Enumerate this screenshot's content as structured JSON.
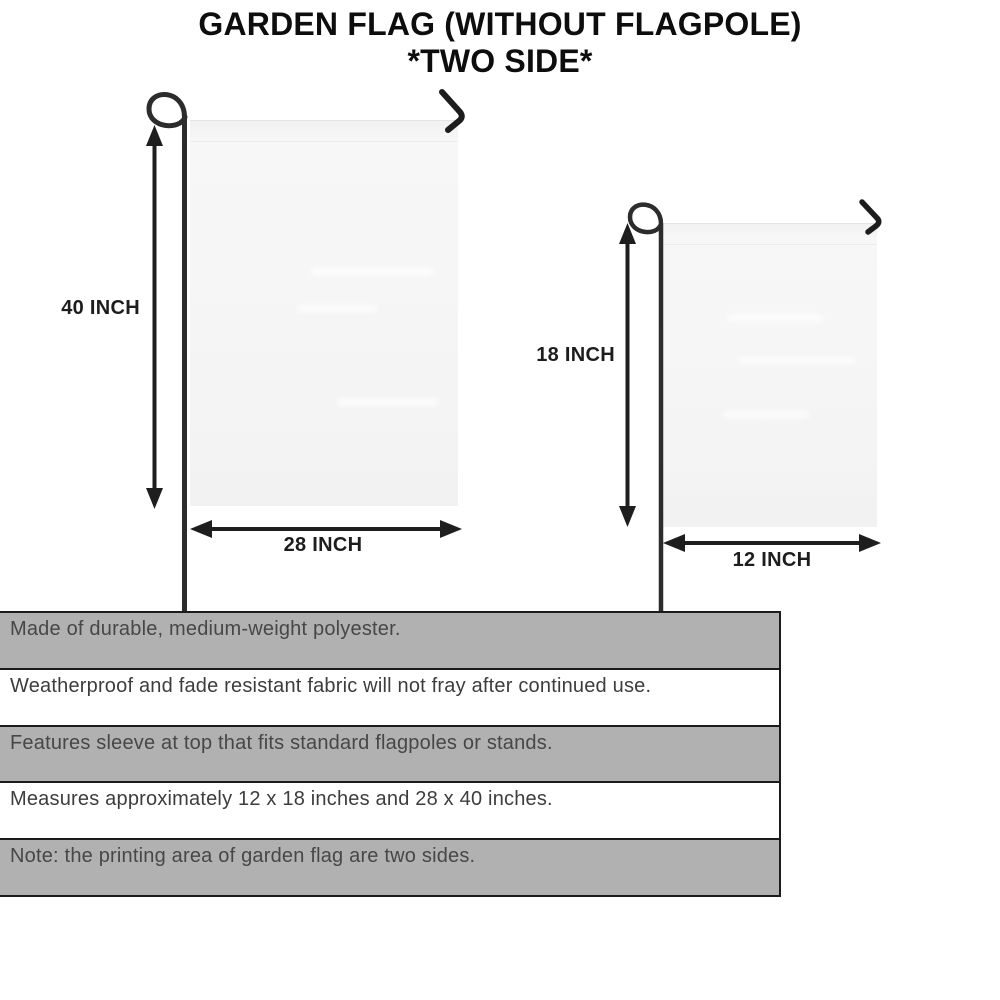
{
  "title": {
    "line1": "GARDEN FLAG (WITHOUT FLAGPOLE)",
    "line2": "*TWO SIDE*"
  },
  "diagrams": {
    "large_flag": {
      "height_label": "40 INCH",
      "width_label": "28 INCH"
    },
    "small_flag": {
      "height_label": "18 INCH",
      "width_label": "12 INCH"
    }
  },
  "features": [
    "Made of durable, medium-weight polyester.",
    "Weatherproof and fade resistant fabric will not fray after continued use.",
    "Features sleeve at top that fits standard flagpoles or stands.",
    "Measures approximately 12 x 18 inches and 28 x 40 inches.",
    "Note: the printing area of garden flag are two sides."
  ],
  "colors": {
    "row_shaded": "#b1b1b1",
    "row_plain": "#ffffff",
    "border": "#1b1b1b",
    "flag_fill": "#f5f5f5",
    "pole": "#2c2c2c",
    "arrow": "#1e1e1e"
  }
}
